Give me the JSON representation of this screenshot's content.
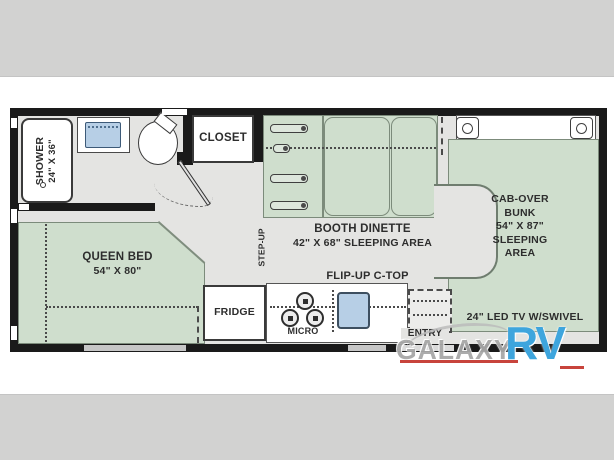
{
  "plan": {
    "shower": {
      "name": "SHOWER",
      "size": "24\" X 36\""
    },
    "closet": {
      "label": "CLOSET"
    },
    "dinette": {
      "name": "BOOTH DINETTE",
      "size": "42\" X 68\" SLEEPING AREA"
    },
    "step_up": {
      "label": "STEP-UP"
    },
    "cab_over": {
      "lines": [
        "CAB-OVER",
        "BUNK",
        "54\" X 87\"",
        "SLEEPING",
        "AREA"
      ]
    },
    "queen_bed": {
      "name": "QUEEN BED",
      "size": "54\" X 80\""
    },
    "fridge": {
      "label": "FRIDGE"
    },
    "micro": {
      "label": "MICRO"
    },
    "flip_up_ctop": {
      "label": "FLIP-UP C-TOP"
    },
    "entry": {
      "label": "ENTRY"
    },
    "tv": {
      "label": "24\" LED TV W/SWIVEL"
    }
  },
  "watermark": {
    "gray": "GALAXY",
    "blue": "RV"
  },
  "colors": {
    "floor": "#e4e4e2",
    "sleeping_area_green": "#cfdecd",
    "sink_blue": "#b7cfe6",
    "wall_black": "#1a1a1a",
    "brand_blue": "#3ea5dd",
    "brand_red": "#c8443c"
  }
}
